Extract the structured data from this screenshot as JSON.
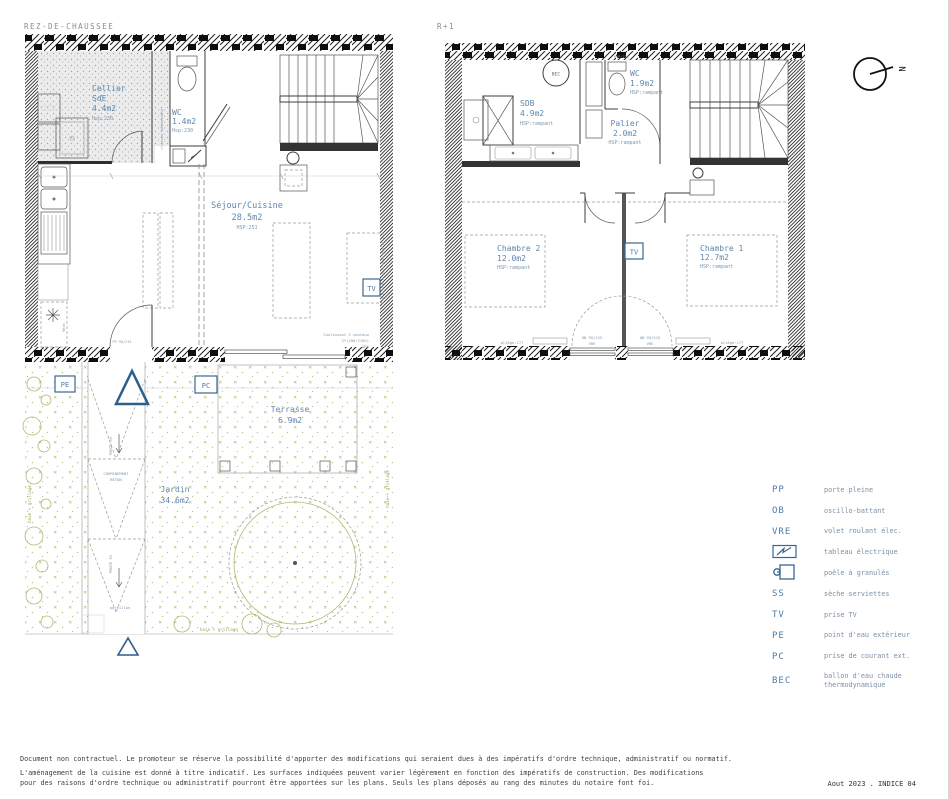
{
  "document": {
    "title_left": "REZ-DE-CHAUSSEE",
    "title_right": "R+1",
    "footer_line1": "Document non contractuel. Le promoteur se réserve la possibilité d'apporter des modifications qui seraient dues à des impératifs d'ordre technique, administratif ou normatif.",
    "footer_line2": "L'aménagement de la cuisine est donné à titre indicatif. Les surfaces indiquées peuvent varier légèrement en fonction des impératifs de construction. Des modifications pour des raisons d'ordre technique ou administratif pourront être apportées sur les plans. Seuls les plans déposés au rang des minutes du notaire font foi.",
    "stamp": "Aout 2023 . INDICE 04"
  },
  "compass": {
    "north": "N"
  },
  "plans": {
    "rdc": {
      "rooms": [
        {
          "name": "Cellier",
          "name2": "SdE",
          "area": "4.4m2",
          "hsp": "Hsp:230"
        },
        {
          "name": "WC",
          "area": "1.4m2",
          "hsp": "Hsp:230"
        },
        {
          "name": "Séjour/Cuisine",
          "area": "28.5m2",
          "hsp": "HSP:251"
        }
      ],
      "outdoor": [
        {
          "name": "Terrasse",
          "area": "6.9m2"
        },
        {
          "name": "Jardin",
          "area": "34.6m2"
        }
      ],
      "annotations": {
        "tv": "TV",
        "pe": "PE",
        "pc": "PC",
        "door": "PP 90/215",
        "sliding1": "Coulissant 2 vantaux",
        "sliding2": "2*(100/215h)",
        "sliding3": "VRE",
        "cloison": "cloison démontable",
        "cheminement1": "CHEMINEMENT",
        "cheminement2": "BETON",
        "pente": "PENTE 5%",
        "portillon": "portillon",
        "haie": "haie + grillage",
        "dim90": "90cm"
      }
    },
    "r1": {
      "rooms": [
        {
          "name": "SDB",
          "area": "4.9m2",
          "hsp": "HSP:rampant"
        },
        {
          "name": "WC",
          "area": "1.9m2",
          "hsp": "HSP:rampant"
        },
        {
          "name": "Palier",
          "area": "2.0m2",
          "hsp": "HSP:rampant"
        },
        {
          "name": "Chambre 2",
          "area": "12.0m2",
          "hsp": "HSP:rampant"
        },
        {
          "name": "Chambre 1",
          "area": "12.7m2",
          "hsp": "HSP:rampant"
        }
      ],
      "annotations": {
        "bec": "BEC",
        "tv": "TV",
        "hsp220": "HSP:220",
        "window": "OB 95/215",
        "vre": "VRE",
        "allege": "allège:177"
      }
    }
  },
  "legend": {
    "items": [
      {
        "abbr": "PP",
        "desc": "porte pleine"
      },
      {
        "abbr": "OB",
        "desc": "oscillo-battant"
      },
      {
        "abbr": "VRE",
        "desc": "volet roulant élec."
      },
      {
        "abbr": "",
        "desc": "tableau électrique"
      },
      {
        "abbr": "",
        "desc": "poêle à granulés"
      },
      {
        "abbr": "SS",
        "desc": "sèche serviettes"
      },
      {
        "abbr": "TV",
        "desc": "prise TV"
      },
      {
        "abbr": "PE",
        "desc": "point d'eau extérieur"
      },
      {
        "abbr": "PC",
        "desc": "prise de courant ext."
      },
      {
        "abbr": "BEC",
        "desc": "ballon d'eau chaude",
        "desc2": "thermodynamique"
      }
    ]
  }
}
